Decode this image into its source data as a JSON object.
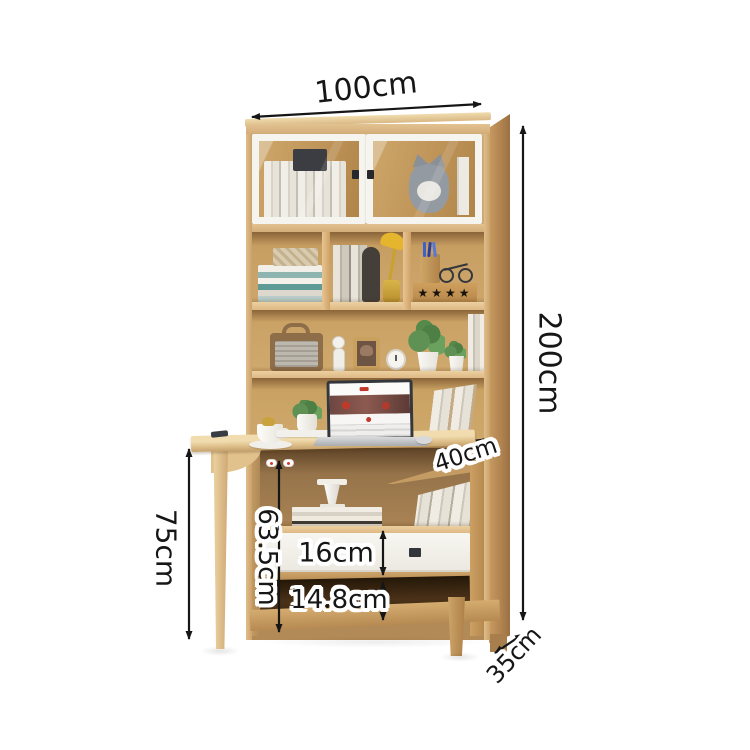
{
  "dimensions": {
    "width": "100cm",
    "height": "200cm",
    "desk_height": "75cm",
    "desk_clearance": "63.5cm",
    "drawer_height": "16cm",
    "bottom_gap": "14.8cm",
    "desk_depth": "40cm",
    "cabinet_depth": "35cm"
  },
  "decor": {
    "star_box_stars": "★★★★"
  },
  "colors": {
    "wood_light": "#e8d0a0",
    "wood_mid": "#cfa76f",
    "wood_dark": "#a87f4c",
    "frame_white": "#f6f4ef",
    "drawer_white": "#f5f3ed",
    "lamp_accent": "#e6b52e",
    "annotation_ink": "#161616"
  }
}
